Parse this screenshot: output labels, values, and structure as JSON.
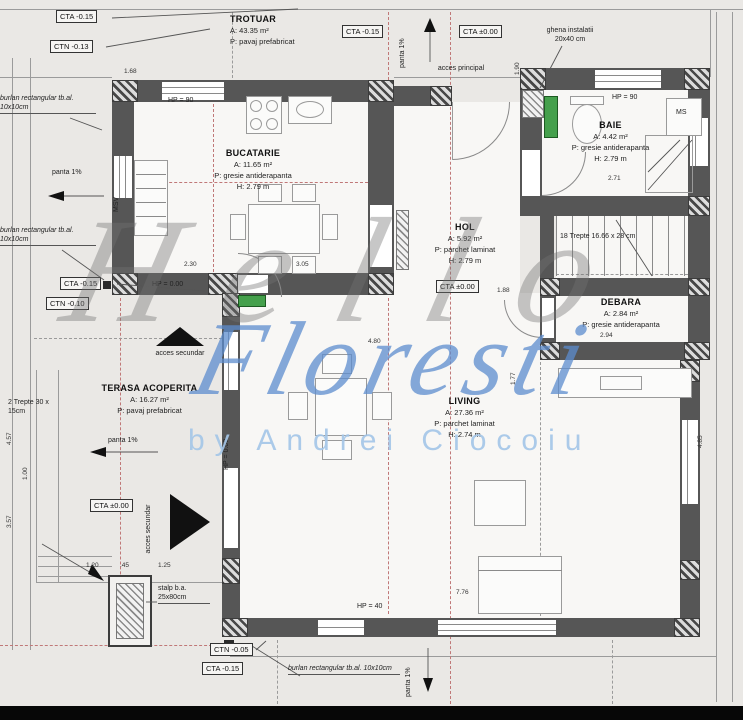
{
  "watermark": {
    "line1": "Hello",
    "line2": "Floresti",
    "line3": "by Andrei Ciocoiu",
    "gray": "#737373",
    "blue": "#5c8ccd",
    "light_blue": "#a4c5e7"
  },
  "colors": {
    "wall": "#565656",
    "background": "#eae8e5",
    "door_green": "#45a04c",
    "axis_red": "#c07878"
  },
  "rooms": {
    "trotuar": {
      "name": "TROTUAR",
      "area": "A: 43.35 m²",
      "floor": "P: pavaj prefabricat"
    },
    "bucatarie": {
      "name": "BUCATARIE",
      "area": "A: 11.65 m²",
      "floor": "P: gresie antiderapanta",
      "height": "H: 2.79 m"
    },
    "baie": {
      "name": "BAIE",
      "area": "A: 4.42 m²",
      "floor": "P: gresie antiderapanta",
      "height": "H: 2.79 m"
    },
    "hol": {
      "name": "HOL",
      "area": "A: 5.92 m²",
      "floor": "P: parchet laminat",
      "height": "H: 2.79 m"
    },
    "debara": {
      "name": "DEBARA",
      "area": "A: 2.84 m²",
      "floor": "P: gresie antiderapanta"
    },
    "living": {
      "name": "LIVING",
      "area": "A: 27.36 m²",
      "floor": "P: parchet laminat",
      "height": "H: 2.74 m"
    },
    "terasa": {
      "name": "TERASA ACOPERITA",
      "area": "A: 16.27 m²",
      "floor": "P: pavaj prefabricat"
    }
  },
  "elevation_labels": [
    {
      "t": "CTA -0.15",
      "x": 56,
      "y": 10
    },
    {
      "t": "CTN -0.13",
      "x": 50,
      "y": 40
    },
    {
      "t": "CTA -0.15",
      "x": 342,
      "y": 25
    },
    {
      "t": "CTA ±0.00",
      "x": 459,
      "y": 25
    },
    {
      "t": "CTA -0.15",
      "x": 60,
      "y": 277
    },
    {
      "t": "CTN -0.10",
      "x": 46,
      "y": 297
    },
    {
      "t": "CTA ±0.00",
      "x": 436,
      "y": 280
    },
    {
      "t": "CTA ±0.00",
      "x": 90,
      "y": 499
    },
    {
      "t": "CTN -0.05",
      "x": 210,
      "y": 643
    },
    {
      "t": "CTA -0.15",
      "x": 202,
      "y": 662
    }
  ],
  "annotations": [
    {
      "t": "HP = 90",
      "x": 168,
      "y": 96
    },
    {
      "t": "HP = 90",
      "x": 612,
      "y": 93
    },
    {
      "t": "HP = 0.00",
      "x": 152,
      "y": 280
    },
    {
      "t": "HP = 0.00",
      "x": 222,
      "y": 470,
      "rot": 1
    },
    {
      "t": "HP = 40",
      "x": 357,
      "y": 602
    },
    {
      "t": "MSV",
      "x": 112,
      "y": 212,
      "rot": 1
    },
    {
      "t": "MS",
      "x": 676,
      "y": 108
    },
    {
      "t": "acces principal",
      "x": 436,
      "y": 64,
      "w": 50,
      "c": 1
    },
    {
      "t": "acces secundar",
      "x": 150,
      "y": 349,
      "w": 60,
      "c": 1
    },
    {
      "t": "acces secundar",
      "x": 144,
      "y": 558,
      "w": 58,
      "c": 1,
      "rot": 1
    },
    {
      "t": "panta 1%",
      "x": 52,
      "y": 168
    },
    {
      "t": "panta 1%",
      "x": 108,
      "y": 436
    },
    {
      "t": "panta 1%",
      "x": 398,
      "y": 68,
      "rot": 1
    },
    {
      "t": "panta 1%",
      "x": 404,
      "y": 697,
      "rot": 1
    },
    {
      "t": "ghena instalatii 20x40 cm",
      "x": 538,
      "y": 26,
      "w": 64,
      "c": 1
    },
    {
      "t": "18 Trepte 16.66 x 28 cm",
      "x": 560,
      "y": 232,
      "w": 130
    },
    {
      "t": "stalp b.a. 25x80cm",
      "x": 158,
      "y": 584,
      "w": 52,
      "u": 1
    },
    {
      "t": "2 Trepte 30 x 15cm",
      "x": 8,
      "y": 398,
      "w": 52
    },
    {
      "t": "burlan rectangular tb.al. 10x10cm",
      "x": 0,
      "y": 94,
      "w": 96,
      "i": 1,
      "u": 1
    },
    {
      "t": "burlan rectangular tb.al. 10x10cm",
      "x": 0,
      "y": 226,
      "w": 96,
      "i": 1,
      "u": 1
    },
    {
      "t": "burlan rectangular tb.al. 10x10cm",
      "x": 288,
      "y": 664,
      "w": 112,
      "i": 1,
      "u": 1
    }
  ],
  "dimensions": [
    {
      "t": "1.68",
      "x": 124,
      "y": 68
    },
    {
      "t": "2.30",
      "x": 184,
      "y": 261
    },
    {
      "t": "3.05",
      "x": 296,
      "y": 261
    },
    {
      "t": "1.88",
      "x": 497,
      "y": 287
    },
    {
      "t": "4.80",
      "x": 368,
      "y": 338
    },
    {
      "t": "2.94",
      "x": 600,
      "y": 332
    },
    {
      "t": "2.71",
      "x": 608,
      "y": 175
    },
    {
      "t": "7.76",
      "x": 456,
      "y": 589
    },
    {
      "t": "1.20",
      "x": 86,
      "y": 562
    },
    {
      "t": ".45",
      "x": 120,
      "y": 562
    },
    {
      "t": "1.25",
      "x": 158,
      "y": 562
    },
    {
      "t": "4.57",
      "x": 6,
      "y": 445,
      "rot": 1
    },
    {
      "t": "3.57",
      "x": 6,
      "y": 528,
      "rot": 1
    },
    {
      "t": "1.00",
      "x": 22,
      "y": 480,
      "rot": 1
    },
    {
      "t": "4.85",
      "x": 697,
      "y": 448,
      "rot": 1
    },
    {
      "t": "1.77",
      "x": 510,
      "y": 385,
      "rot": 1
    },
    {
      "t": "1.90",
      "x": 514,
      "y": 75,
      "rot": 1
    }
  ]
}
